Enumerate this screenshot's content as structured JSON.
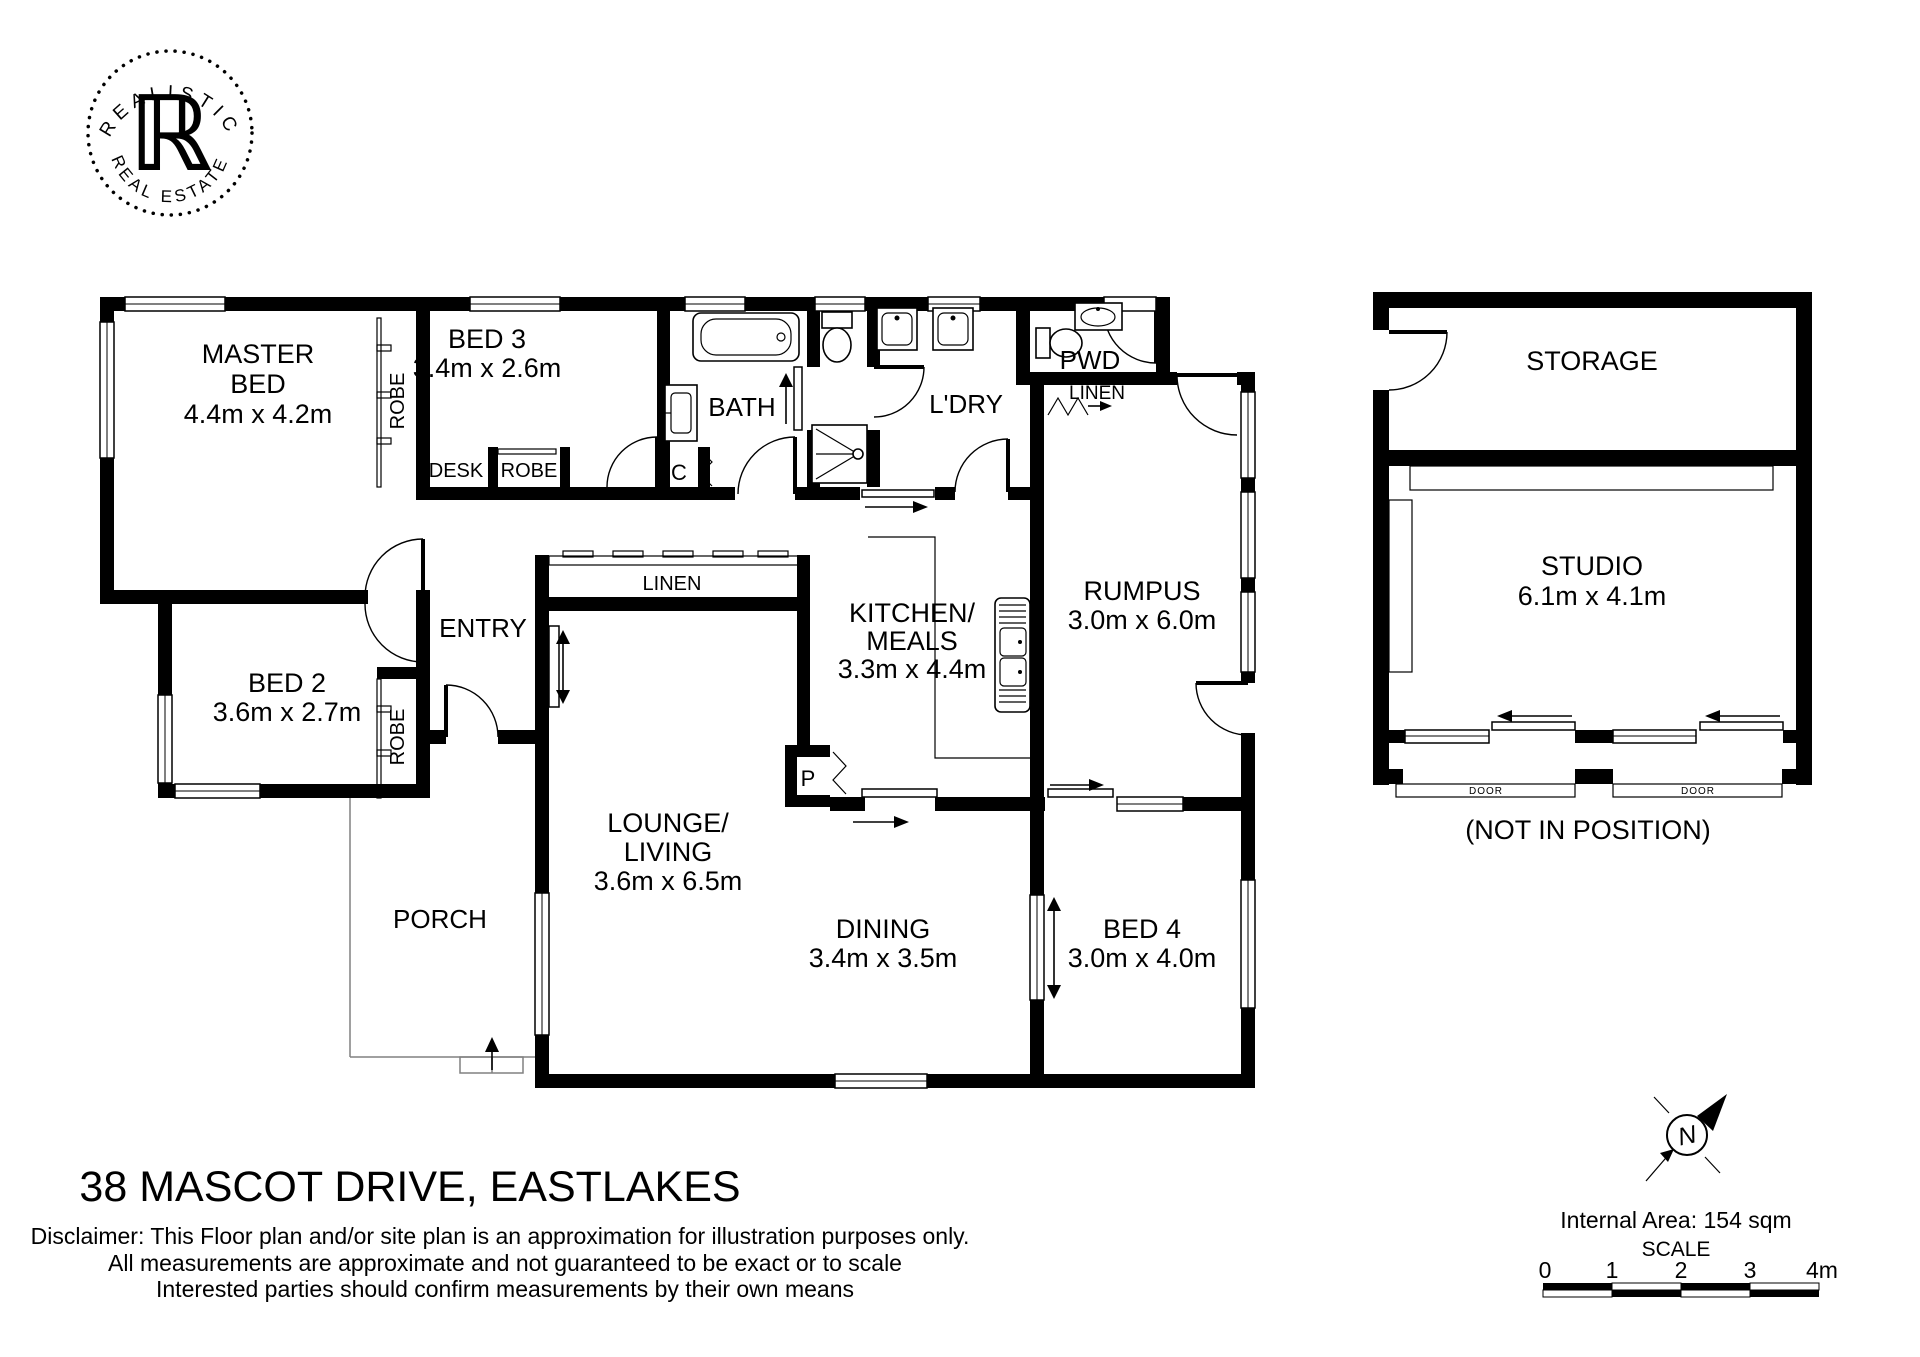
{
  "logo": {
    "arc_top": "REALISTIC",
    "arc_bottom": "REAL ESTATE",
    "monogram": "ℝ"
  },
  "plan": {
    "rooms": {
      "master_bed": {
        "line1": "MASTER",
        "line2": "BED",
        "dims": "4.4m x 4.2m"
      },
      "bed2": {
        "line1": "BED 2",
        "dims": "3.6m x 2.7m"
      },
      "bed3": {
        "line1": "BED 3",
        "dims": "3.4m x 2.6m"
      },
      "bed4": {
        "line1": "BED 4",
        "dims": "3.0m x 4.0m"
      },
      "lounge": {
        "line1": "LOUNGE/",
        "line2": "LIVING",
        "dims": "3.6m x 6.5m"
      },
      "dining": {
        "line1": "DINING",
        "dims": "3.4m x 3.5m"
      },
      "kitchen": {
        "line1": "KITCHEN/",
        "line2": "MEALS",
        "dims": "3.3m x 4.4m"
      },
      "rumpus": {
        "line1": "RUMPUS",
        "dims": "3.0m x 6.0m"
      },
      "entry": {
        "label": "ENTRY"
      },
      "porch": {
        "label": "PORCH"
      },
      "bath": {
        "label": "BATH"
      },
      "laundry": {
        "label": "L'DRY"
      },
      "powder": {
        "label": "PWD"
      },
      "linen_hall": {
        "label": "LINEN"
      },
      "linen_pwd": {
        "label": "LINEN"
      },
      "closet": {
        "label": "C"
      },
      "pantry": {
        "label": "P"
      },
      "desk": {
        "label": "DESK"
      },
      "robe_master": {
        "label": "ROBE"
      },
      "robe_bed2": {
        "label": "ROBE"
      },
      "robe_bed3": {
        "label": "ROBE"
      }
    },
    "studio": {
      "storage": {
        "label": "STORAGE"
      },
      "studio": {
        "line1": "STUDIO",
        "dims": "6.1m x 4.1m"
      },
      "door_left": {
        "label": "DOOR"
      },
      "door_right": {
        "label": "DOOR"
      },
      "note": "(NOT IN POSITION)"
    }
  },
  "title": "38 MASCOT DRIVE, EASTLAKES",
  "disclaimer": {
    "line1": "Disclaimer: This Floor plan and/or site plan is an approximation for illustration purposes only.",
    "line2": "All measurements are approximate and not guaranteed to be exact or to scale",
    "line3": "Interested parties should confirm measurements by their own means"
  },
  "footer": {
    "north_label": "N",
    "internal_area": "Internal Area: 154 sqm",
    "scale_label": "SCALE",
    "scale_ticks": [
      "0",
      "1",
      "2",
      "3",
      "4m"
    ]
  },
  "colors": {
    "ink": "#000000",
    "paper": "#ffffff"
  }
}
